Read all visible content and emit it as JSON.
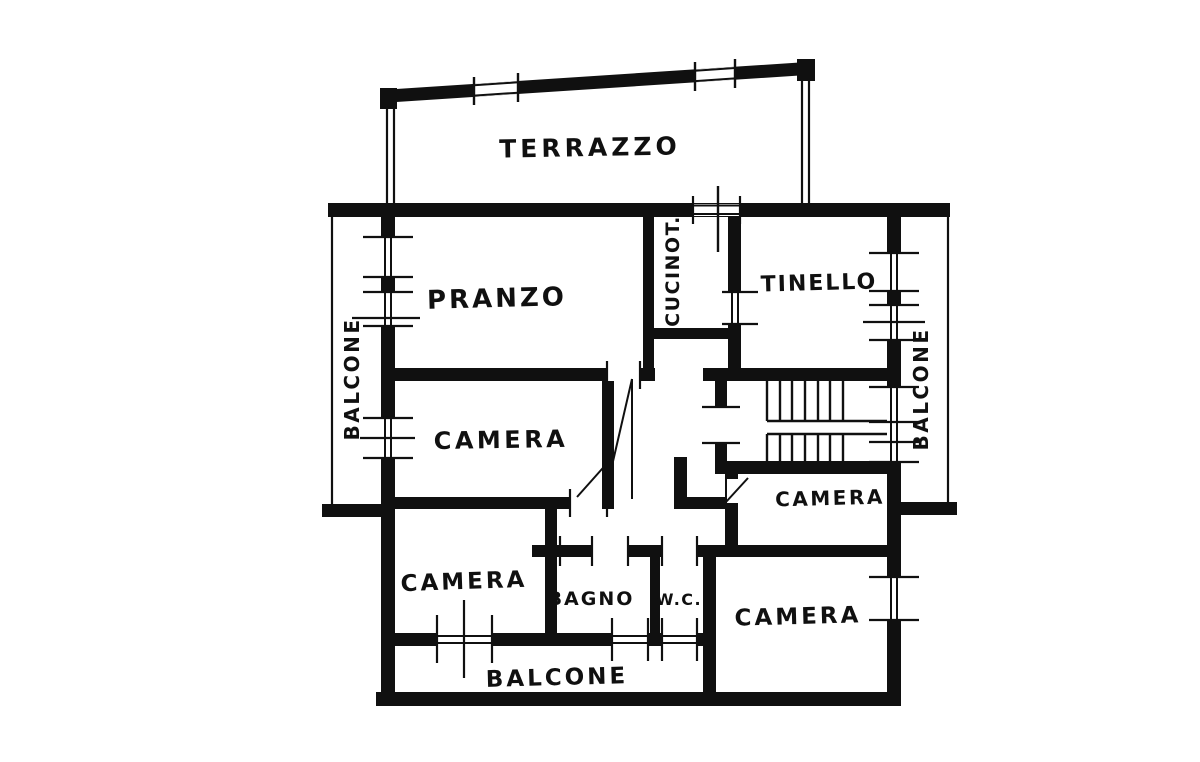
{
  "drawing": {
    "type": "apartment floor plan",
    "ink_color": "#101010",
    "paper_color": "#ffffff"
  },
  "labels": {
    "terrazzo": "TERRAZZO",
    "pranzo": "PRANZO",
    "cucinotto": "CUCINOT.",
    "tinello": "TINELLO",
    "balcone_left": "BALCONE",
    "balcone_right": "BALCONE",
    "balcone_bottom": "BALCONE",
    "camera_top": "CAMERA",
    "camera_mid_right": "CAMERA",
    "camera_bottom_left": "CAMERA",
    "camera_bottom_right": "CAMERA",
    "bagno": "BAGNO",
    "wc": "W.C."
  }
}
